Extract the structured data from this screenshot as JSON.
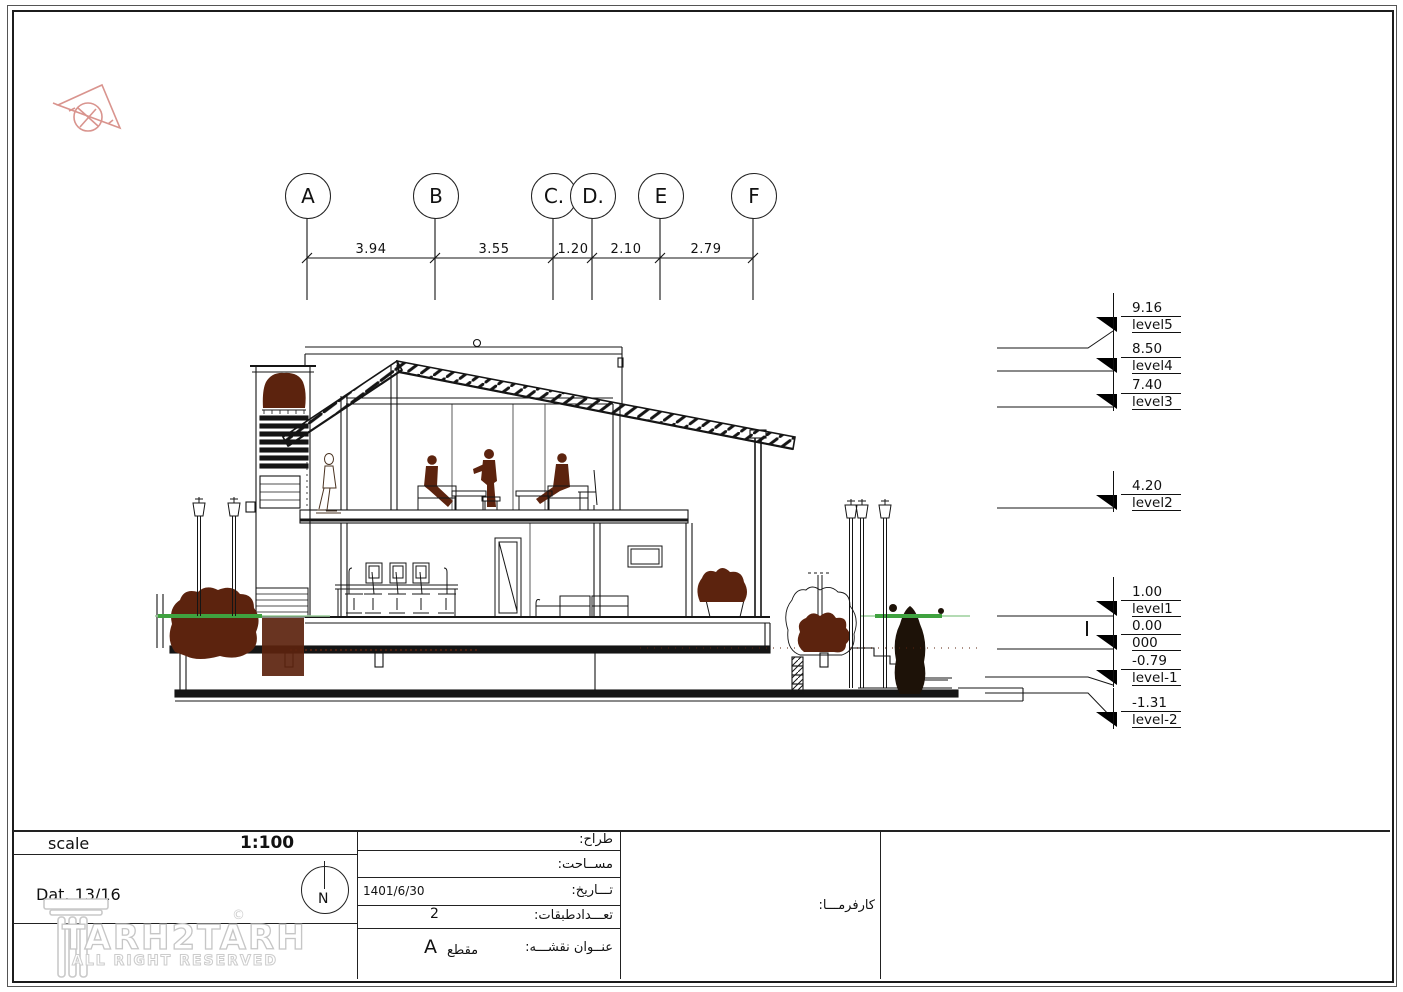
{
  "watermark": {
    "brand": "TARH2TARH",
    "tagline": "ALL RIGHT RESERVED",
    "copyright": "©"
  },
  "grid": {
    "bubbles": [
      {
        "label": "A"
      },
      {
        "label": "B"
      },
      {
        "label": "C."
      },
      {
        "label": "D."
      },
      {
        "label": "E"
      },
      {
        "label": "F"
      }
    ],
    "dimensions": [
      {
        "value": "3.94"
      },
      {
        "value": "3.55"
      },
      {
        "value": "1.20"
      },
      {
        "value": "2.10"
      },
      {
        "value": "2.79"
      }
    ]
  },
  "levels": [
    {
      "value": "9.16",
      "label": "level5"
    },
    {
      "value": "8.50",
      "label": "level4"
    },
    {
      "value": "7.40",
      "label": "level3"
    },
    {
      "value": "4.20",
      "label": "level2"
    },
    {
      "value": "1.00",
      "label": "level1"
    },
    {
      "value": "0.00",
      "label": "000"
    },
    {
      "value": "-0.79",
      "label": "level-1"
    },
    {
      "value": "-1.31",
      "label": "level-2"
    }
  ],
  "titleblock": {
    "scale_label": "scale",
    "scale_value": "1:100",
    "date_note": "Dat.  13/16",
    "north_letter": "N",
    "fields": [
      {
        "label": "طراح:",
        "value": ""
      },
      {
        "label": "مســاحت:",
        "value": ""
      },
      {
        "label": "تـــاريخ:",
        "value": "1401/6/30"
      },
      {
        "label": "تعـــدادطبقات:",
        "value": "2"
      },
      {
        "label": "عنــوان نقشـــه:",
        "value": "مقطع",
        "value_letter": "A"
      }
    ],
    "client_label": "كارفرمـــا:"
  },
  "colors": {
    "ink": "#151515",
    "brown": "#5C230E",
    "green": "#3FA23F",
    "logo_red": "#D9948E"
  }
}
